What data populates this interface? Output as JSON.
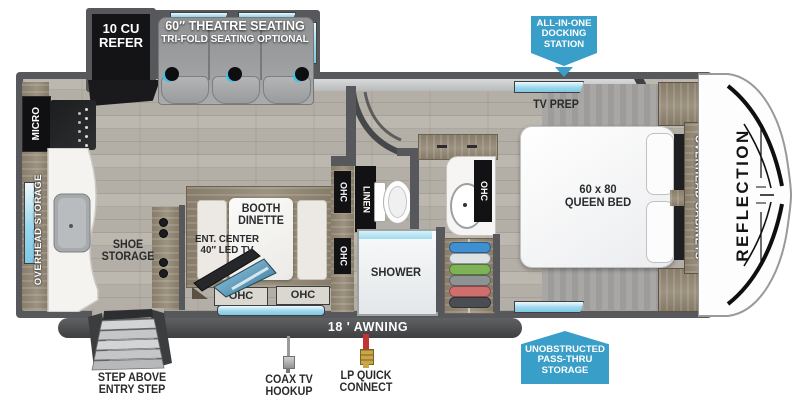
{
  "callouts": {
    "docking_station": {
      "lines": [
        "ALL-IN-ONE",
        "DOCKING",
        "STATION"
      ]
    },
    "pass_thru": {
      "lines": [
        "UNOBSTRUCTED",
        "PASS-THRU",
        "STORAGE"
      ]
    }
  },
  "exterior": {
    "awning": "18 ' AWNING",
    "step_label": [
      "STEP ABOVE",
      "ENTRY STEP"
    ],
    "coax_label": [
      "COAX TV",
      "HOOKUP"
    ],
    "lp_label": [
      "LP QUICK",
      "CONNECT"
    ]
  },
  "kitchen": {
    "refer": [
      "10 CU",
      "REFER"
    ],
    "micro": "MICRO",
    "overhead_storage": "OVERHEAD STORAGE",
    "shoe_storage": [
      "SHOE",
      "STORAGE"
    ]
  },
  "living": {
    "theatre": [
      "60″ THEATRE SEATING",
      "TRI-FOLD SEATING OPTIONAL"
    ],
    "booth": [
      "BOOTH",
      "DINETTE"
    ],
    "ent_center": [
      "ENT. CENTER",
      "40″ LED TV"
    ],
    "ohc": "OHC"
  },
  "bath": {
    "linen": "LINEN",
    "shower": "SHOWER",
    "ohc": "OHC"
  },
  "bedroom": {
    "tv_prep": "TV PREP",
    "bed": [
      "60 x 80",
      "QUEEN BED"
    ],
    "overhead_cabinets": "OVERHEAD CABINETS"
  },
  "brand": {
    "reflection": "REFLECTION"
  },
  "colors": {
    "accent_blue": "#3A9FC8",
    "wall_gray": "#57585B",
    "floor_tan": "#B4AFA6",
    "wood_tan": "#8E8371",
    "window_blue": "#9FD7EC",
    "appliance_black": "#141416"
  }
}
